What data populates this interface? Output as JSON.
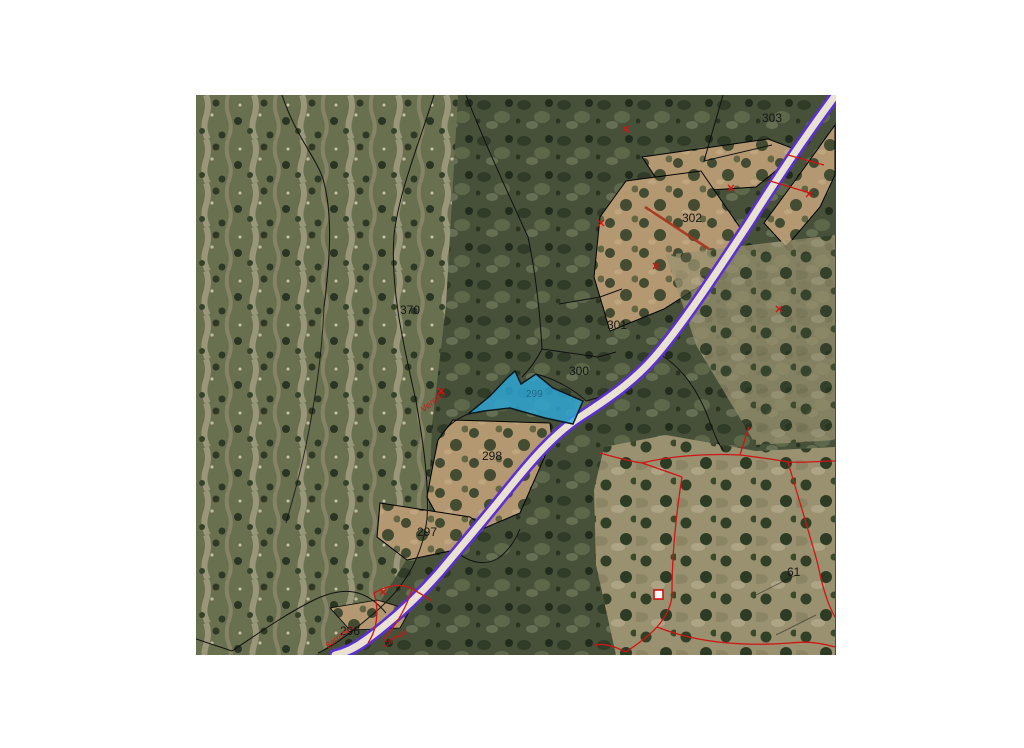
{
  "window": {
    "background_color": "#ffffff"
  },
  "map": {
    "kind": "cadastral parcel map over aerial orthophoto",
    "selected_parcel_id": "299",
    "colors": {
      "highlight_fill": "#2da8d9",
      "road_casing": "#5b2fd6",
      "road_fill": "#e9e1d1",
      "parcel_boundary": "#000000",
      "cadastral_overlay": "#d11414",
      "label_text": "#161616"
    },
    "parcel_labels": [
      {
        "id": "370",
        "label": "370"
      },
      {
        "id": "303",
        "label": "303"
      },
      {
        "id": "302",
        "label": "302"
      },
      {
        "id": "301",
        "label": "301"
      },
      {
        "id": "300",
        "label": "300"
      },
      {
        "id": "299",
        "label": "299"
      },
      {
        "id": "298",
        "label": "298"
      },
      {
        "id": "297",
        "label": "297"
      },
      {
        "id": "296",
        "label": "296"
      },
      {
        "id": "61",
        "label": "61"
      }
    ],
    "annotations": [
      {
        "text": "Vereda"
      },
      {
        "text": "Barranco"
      },
      {
        "text": "Camino"
      }
    ]
  }
}
